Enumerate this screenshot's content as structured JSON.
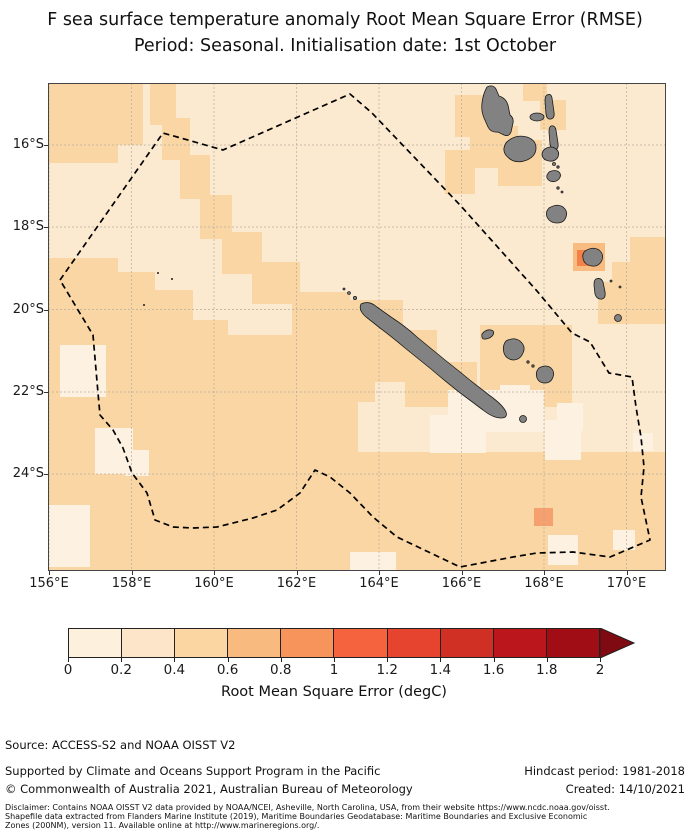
{
  "title": {
    "line1": "F sea surface temperature anomaly Root Mean Square Error (RMSE)",
    "line2": "Period: Seasonal. Initialisation date: 1st October"
  },
  "map": {
    "lat_ticks": [
      "16°S",
      "18°S",
      "20°S",
      "22°S",
      "24°S"
    ],
    "lon_ticks": [
      "156°E",
      "158°E",
      "160°E",
      "162°E",
      "164°E",
      "166°E",
      "168°E",
      "170°E"
    ],
    "colors": {
      "bin1": "#fdf2e1",
      "bin2": "#fcead0",
      "bin3": "#f9d6a3",
      "cellA": "#f5a06e",
      "cellB": "#f9bc80",
      "cellC": "#f2814a",
      "land": "#828282"
    },
    "overlay_names": [
      "new-caledonia-eez-dashed-boundary",
      "land-new-caledonia",
      "land-loyalty-islands",
      "land-vanuatu"
    ]
  },
  "colorbar": {
    "tick_labels": [
      "0",
      "0.2",
      "0.4",
      "0.6",
      "0.8",
      "1",
      "1.2",
      "1.4",
      "1.6",
      "1.8",
      "2"
    ],
    "colors": [
      "#fdf0dd",
      "#fce5c8",
      "#fbd5a2",
      "#f8ba7f",
      "#f6945c",
      "#f4623e",
      "#e74430",
      "#d02f24",
      "#ba161b",
      "#a00d14"
    ],
    "arrow_color": "#7f0a11",
    "label": "Root Mean Square Error (degC)"
  },
  "footer": {
    "source": "Source: ACCESS-S2 and NOAA OISST V2",
    "supported": "Supported by Climate and Oceans Support Program in the Pacific",
    "copyright": "© Commonwealth of Australia 2021, Australian Bureau of Meteorology",
    "hindcast": "Hindcast period: 1981-2018",
    "created": "Created: 14/10/2021",
    "disclaimer_line1": "Disclaimer: Contains NOAA OISST V2 data provided by NOAA/NCEI, Asheville, North Carolina, USA, from their website https://www.ncdc.noaa.gov/oisst.",
    "disclaimer_line2": "Shapefile data extracted from Flanders Marine Institute (2019), Maritime Boundaries Geodatabase: Maritime Boundaries and Exclusive Economic",
    "disclaimer_line3": "Zones (200NM), version 11. Available online at http://www.marineregions.org/."
  },
  "chart_data": {
    "type": "heatmap",
    "title": "F sea surface temperature anomaly Root Mean Square Error (RMSE)",
    "subtitle": "Period: Seasonal. Initialisation date: 1st October",
    "x_ticks_lon_E": [
      156,
      158,
      160,
      162,
      164,
      166,
      168,
      170
    ],
    "y_ticks_lat_S": [
      16,
      18,
      20,
      22,
      24
    ],
    "xlim_lon_E": [
      156,
      171
    ],
    "ylim_lat_S": [
      14.5,
      26.4
    ],
    "grid": true,
    "colorbar": {
      "label": "Root Mean Square Error (degC)",
      "ticks": [
        0,
        0.2,
        0.4,
        0.6,
        0.8,
        1,
        1.2,
        1.4,
        1.6,
        1.8,
        2
      ],
      "extend": "max",
      "units": "degC"
    },
    "regions": [
      {
        "area": "northeast sector (around Vanuatu and east of New Caledonia)",
        "rmse_degC": "0.2-0.4"
      },
      {
        "area": "southwest and southern Coral Sea (west/south of New Caledonia)",
        "rmse_degC": "0.4-0.6"
      },
      {
        "area": "scattered small patches throughout",
        "rmse_degC": "0-0.2"
      },
      {
        "area": "cells around Erromango, Vanuatu (~169.1E, 18.7S)",
        "rmse_degC": "0.6-1.0"
      },
      {
        "area": "isolated cell near 167.9E, 25.0S",
        "rmse_degC": "0.6-0.8"
      }
    ],
    "overlays": [
      "New Caledonia EEZ dashed boundary polygon",
      "grey land: New Caledonia (Grande Terre), Loyalty Islands, Isle of Pines, Vanuatu archipelago"
    ]
  }
}
